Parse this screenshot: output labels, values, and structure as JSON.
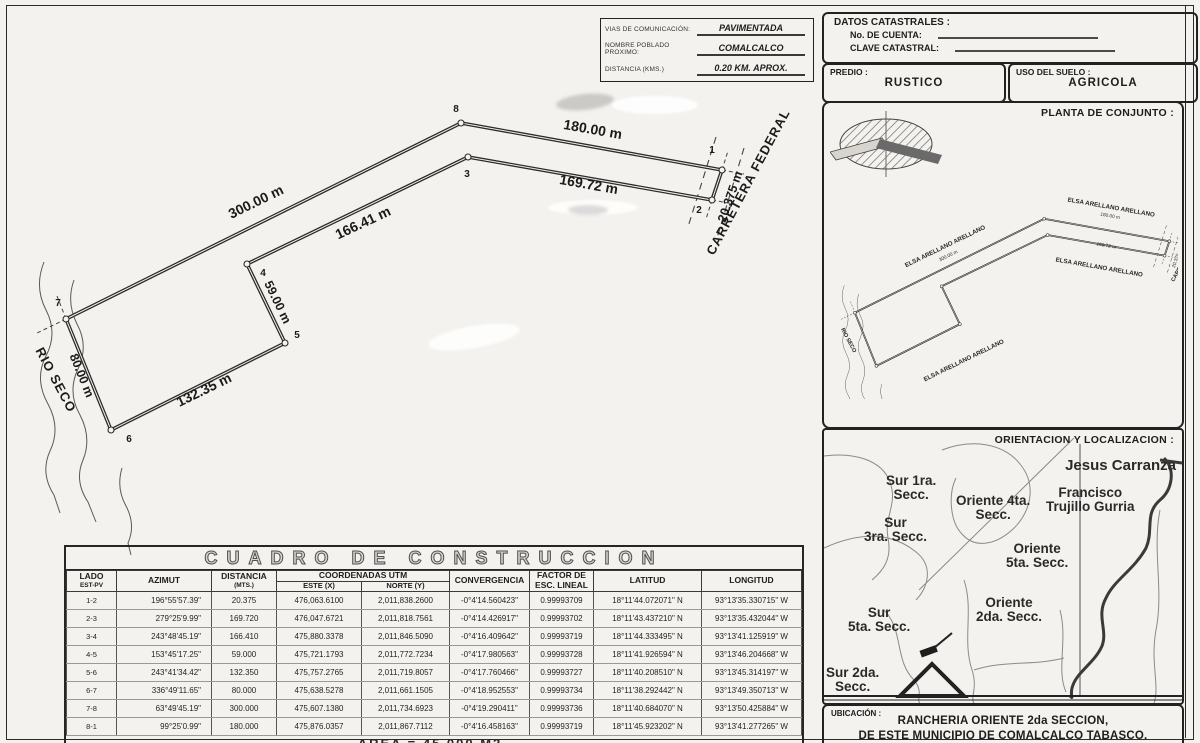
{
  "comm_box": {
    "rows": [
      {
        "label": "VIAS DE COMUNICACIÓN:",
        "value": "PAVIMENTADA"
      },
      {
        "label": "NOMBRE POBLADO PROXIMO:",
        "value": "COMALCALCO"
      },
      {
        "label": "DISTANCIA (KMS.)",
        "value": "0.20 KM. APROX."
      }
    ]
  },
  "catastral": {
    "title": "DATOS CATASTRALES :",
    "cuenta_label": "No. DE CUENTA:",
    "clave_label": "CLAVE CATASTRAL:"
  },
  "predio": {
    "label": "PREDIO :",
    "value": "RUSTICO"
  },
  "uso_suelo": {
    "label": "USO DEL SUELO :",
    "value": "AGRICOLA"
  },
  "site_plan": {
    "title": "PLANTA DE CONJUNTO :",
    "neighbor_top": "ELSA ARELLANO ARELLANO",
    "neighbor_left": "ELSA ARELLANO ARELLANO",
    "neighbor_center": "ELSA ARELLANO ARELLANO",
    "neighbor_bottom": "ELSA ARELLANO ARELLANO",
    "road_label": "CARRETERA FEDERAL",
    "river_label": "RIO SECO",
    "dim_top": "180.00 m",
    "dim_left": "300.00 m",
    "dim_diag": "169.72 m",
    "dim_right": "20.375 m"
  },
  "location_map": {
    "title": "ORIENTACION Y LOCALIZACION :",
    "jesus": "Jesus Carranza",
    "sur1a": "Sur 1ra.",
    "sur1b": "Secc.",
    "ori4a": "Oriente 4ta.",
    "ori4b": "Secc.",
    "frana": "Francisco",
    "franb": "Trujillo Gurria",
    "sur3a": "Sur",
    "sur3b": "3ra. Secc.",
    "ori5a": "Oriente",
    "ori5b": "5ta. Secc.",
    "sur5a": "Sur",
    "sur5b": "5ta. Secc.",
    "ori2a": "Oriente",
    "ori2b": "2da. Secc.",
    "sur2a": "Sur 2da.",
    "sur2b": "Secc."
  },
  "ubicacion": {
    "label": "UBICACIÓN :",
    "line1": "RANCHERIA ORIENTE  2da SECCION,",
    "line2": "DE ESTE MUNICIPIO DE COMALCALCO TABASCO."
  },
  "drawing": {
    "vertices": {
      "v1": "1",
      "v2": "2",
      "v3": "3",
      "v4": "4",
      "v5": "5",
      "v6": "6",
      "v7": "7",
      "v8": "8"
    },
    "distances": {
      "d12": "20.375 m",
      "d23": "169.72 m",
      "d34": "166.41 m",
      "d45": "59.00 m",
      "d56": "132.35 m",
      "d67": "80.00 m",
      "d78": "300.00 m",
      "d81": "180.00 m"
    },
    "river_label": "RIO SECO",
    "road_label": "CARRETERA FEDERAL"
  },
  "construction_table": {
    "title": "CUADRO DE CONSTRUCCION",
    "headers": {
      "lado": "LADO",
      "lado_sub": "EST-PV",
      "azimut": "AZIMUT",
      "dist": "DISTANCIA",
      "dist_sub": "(MTS.)",
      "coord": "COORDENADAS UTM",
      "este": "ESTE (X)",
      "norte": "NORTE (Y)",
      "conv": "CONVERGENCIA",
      "factor": "FACTOR DE",
      "factor2": "ESC. LINEAL",
      "lat": "LATITUD",
      "lon": "LONGITUD"
    },
    "rows": [
      {
        "lado": "1-2",
        "azimut": "196°55'57.39\"",
        "dist": "20.375",
        "este": "476,063.6100",
        "norte": "2,011,838.2600",
        "conv": "-0°4'14.560423\"",
        "factor": "0.99993709",
        "lat": "18°11'44.072071\" N",
        "lon": "93°13'35.330715\" W"
      },
      {
        "lado": "2-3",
        "azimut": "279°25'9.99\"",
        "dist": "169.720",
        "este": "476,047.6721",
        "norte": "2,011,818.7561",
        "conv": "-0°4'14.426917\"",
        "factor": "0.99993702",
        "lat": "18°11'43.437210\" N",
        "lon": "93°13'35.432044\" W"
      },
      {
        "lado": "3-4",
        "azimut": "243°48'45.19\"",
        "dist": "166.410",
        "este": "475,880.3378",
        "norte": "2,011,846.5090",
        "conv": "-0°4'16.409642\"",
        "factor": "0.99993719",
        "lat": "18°11'44.333495\" N",
        "lon": "93°13'41.125919\" W"
      },
      {
        "lado": "4-5",
        "azimut": "153°45'17.25\"",
        "dist": "59.000",
        "este": "475,721.1793",
        "norte": "2,011,772.7234",
        "conv": "-0°4'17.980563\"",
        "factor": "0.99993728",
        "lat": "18°11'41.926594\" N",
        "lon": "93°13'46.204668\" W"
      },
      {
        "lado": "5-6",
        "azimut": "243°41'34.42\"",
        "dist": "132.350",
        "este": "475,757.2765",
        "norte": "2,011,719.8057",
        "conv": "-0°4'17.760466\"",
        "factor": "0.99993727",
        "lat": "18°11'40.208510\" N",
        "lon": "93°13'45.314197\" W"
      },
      {
        "lado": "6-7",
        "azimut": "336°49'11.65\"",
        "dist": "80.000",
        "este": "475,638.5278",
        "norte": "2,011,661.1505",
        "conv": "-0°4'18.952553\"",
        "factor": "0.99993734",
        "lat": "18°11'38.292442\" N",
        "lon": "93°13'49.350713\" W"
      },
      {
        "lado": "7-8",
        "azimut": "63°49'45.19\"",
        "dist": "300.000",
        "este": "475,607.1380",
        "norte": "2,011,734.6923",
        "conv": "-0°4'19.290411\"",
        "factor": "0.99993736",
        "lat": "18°11'40.684070\" N",
        "lon": "93°13'50.425884\" W"
      },
      {
        "lado": "8-1",
        "azimut": "99°25'0.99\"",
        "dist": "180.000",
        "este": "475,876.0357",
        "norte": "2,011,867.7112",
        "conv": "-0°4'16.458163\"",
        "factor": "0.99993719",
        "lat": "18°11'45.923202\" N",
        "lon": "93°13'41.277265\" W"
      }
    ],
    "area_note": "AREA = 45,000 M2"
  }
}
